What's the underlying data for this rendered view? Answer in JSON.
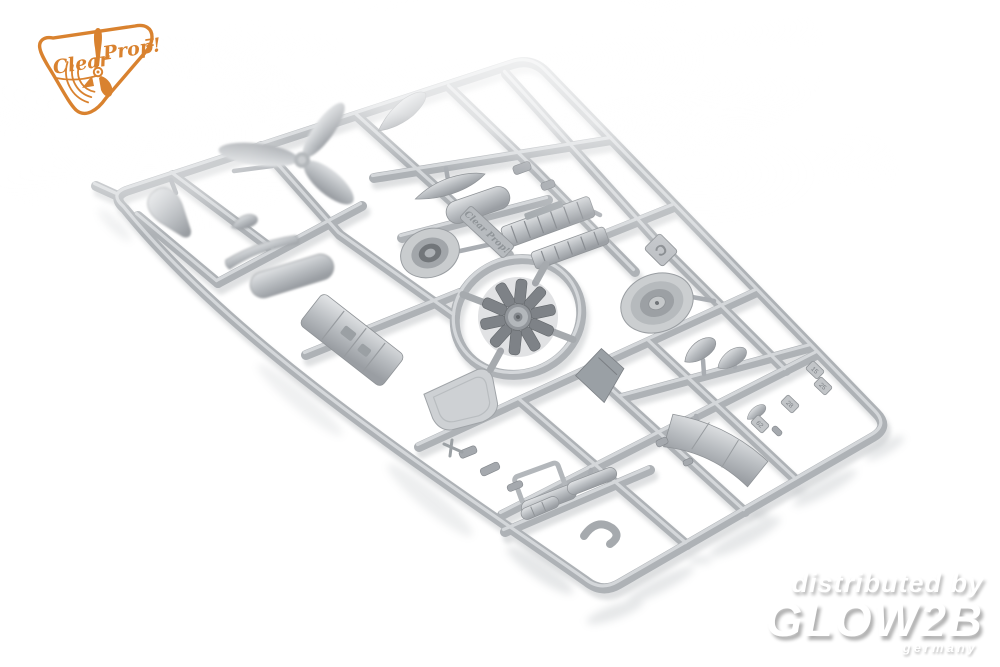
{
  "photo": {
    "subject": "Grey styrene model kit parts sprue photographed diagonally on a white studio background",
    "background_color": "#ffffff"
  },
  "branding": {
    "logo_word1": "Clear",
    "logo_word2": "Prop!",
    "logo_color": "#d9822f"
  },
  "watermark": {
    "line1": "distributed by",
    "line2": "GLOW2B",
    "line3": "germany",
    "shadow_color": "#b6b6b6"
  },
  "sprue": {
    "letter": "C",
    "embossed_brand": "Clear Prop!",
    "plastic_base_color": "#aeb2b6",
    "plastic_highlight_color": "#d9dcdf",
    "plastic_shadow_color": "#8f9397",
    "part_number_tags": [
      "15",
      "25",
      "28",
      "62"
    ],
    "parts": [
      "spinner-cone",
      "three-blade-propeller",
      "propeller-blade",
      "small-teardrop-fairing",
      "exhaust-collector-bar",
      "drop-tank-large",
      "fuselage-boat-part",
      "drop-tank-right",
      "cowling-ring",
      "embossed-brand-plate",
      "engine-cylinder-bank-1",
      "engine-cylinder-bank-2",
      "sprue-letter-tab",
      "cowling-front-disc",
      "radial-engine",
      "cockpit-floor",
      "firewall-bulkhead",
      "seat",
      "fairing-teardrop-pair",
      "cowl-flap-band",
      "exhaust-stubs",
      "canopy-frame",
      "small-capsules",
      "intake-hook-pipe",
      "number-tabs"
    ]
  }
}
